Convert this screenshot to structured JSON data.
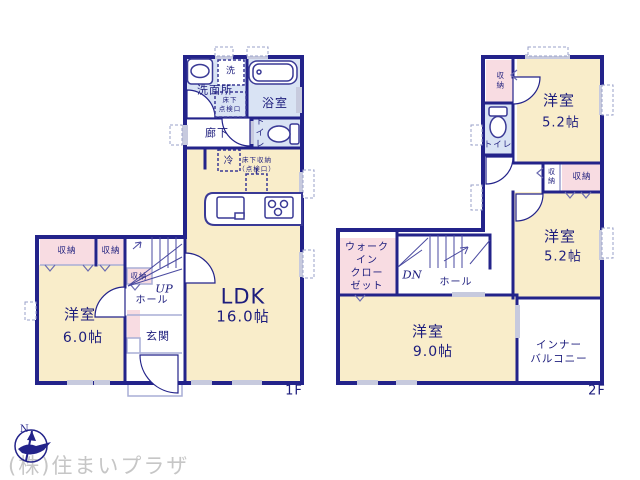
{
  "watermark": {
    "company": "(株)住まいプラザ",
    "compass_n": "N"
  },
  "common": {
    "storage": "収納",
    "western_room": "洋室",
    "hall": "ホール",
    "toilet": "トイレ",
    "size_5_2": "5.2帖"
  },
  "floor1": {
    "label": "1F",
    "washroom": "洗面所",
    "laundry": "洗",
    "bathroom": "浴室",
    "underfloor_hatch_line1": "床下",
    "underfloor_hatch_line2": "点検口",
    "corridor": "廊下",
    "fridge": "冷",
    "underfloor_storage_line1": "床下収納",
    "underfloor_storage_line2": "（点検口）",
    "ldk": "LDK",
    "ldk_size": "16.0帖",
    "up": "UP",
    "entrance": "玄関",
    "room6_size": "6.0帖"
  },
  "floor2": {
    "label": "2F",
    "walkin_line1": "ウォーク",
    "walkin_line2": "イン",
    "walkin_line3": "クロー",
    "walkin_line4": "ゼット",
    "dn": "DN",
    "room9_size": "9.0帖",
    "balcony_line1": "インナー",
    "balcony_line2": "バルコニー"
  }
}
